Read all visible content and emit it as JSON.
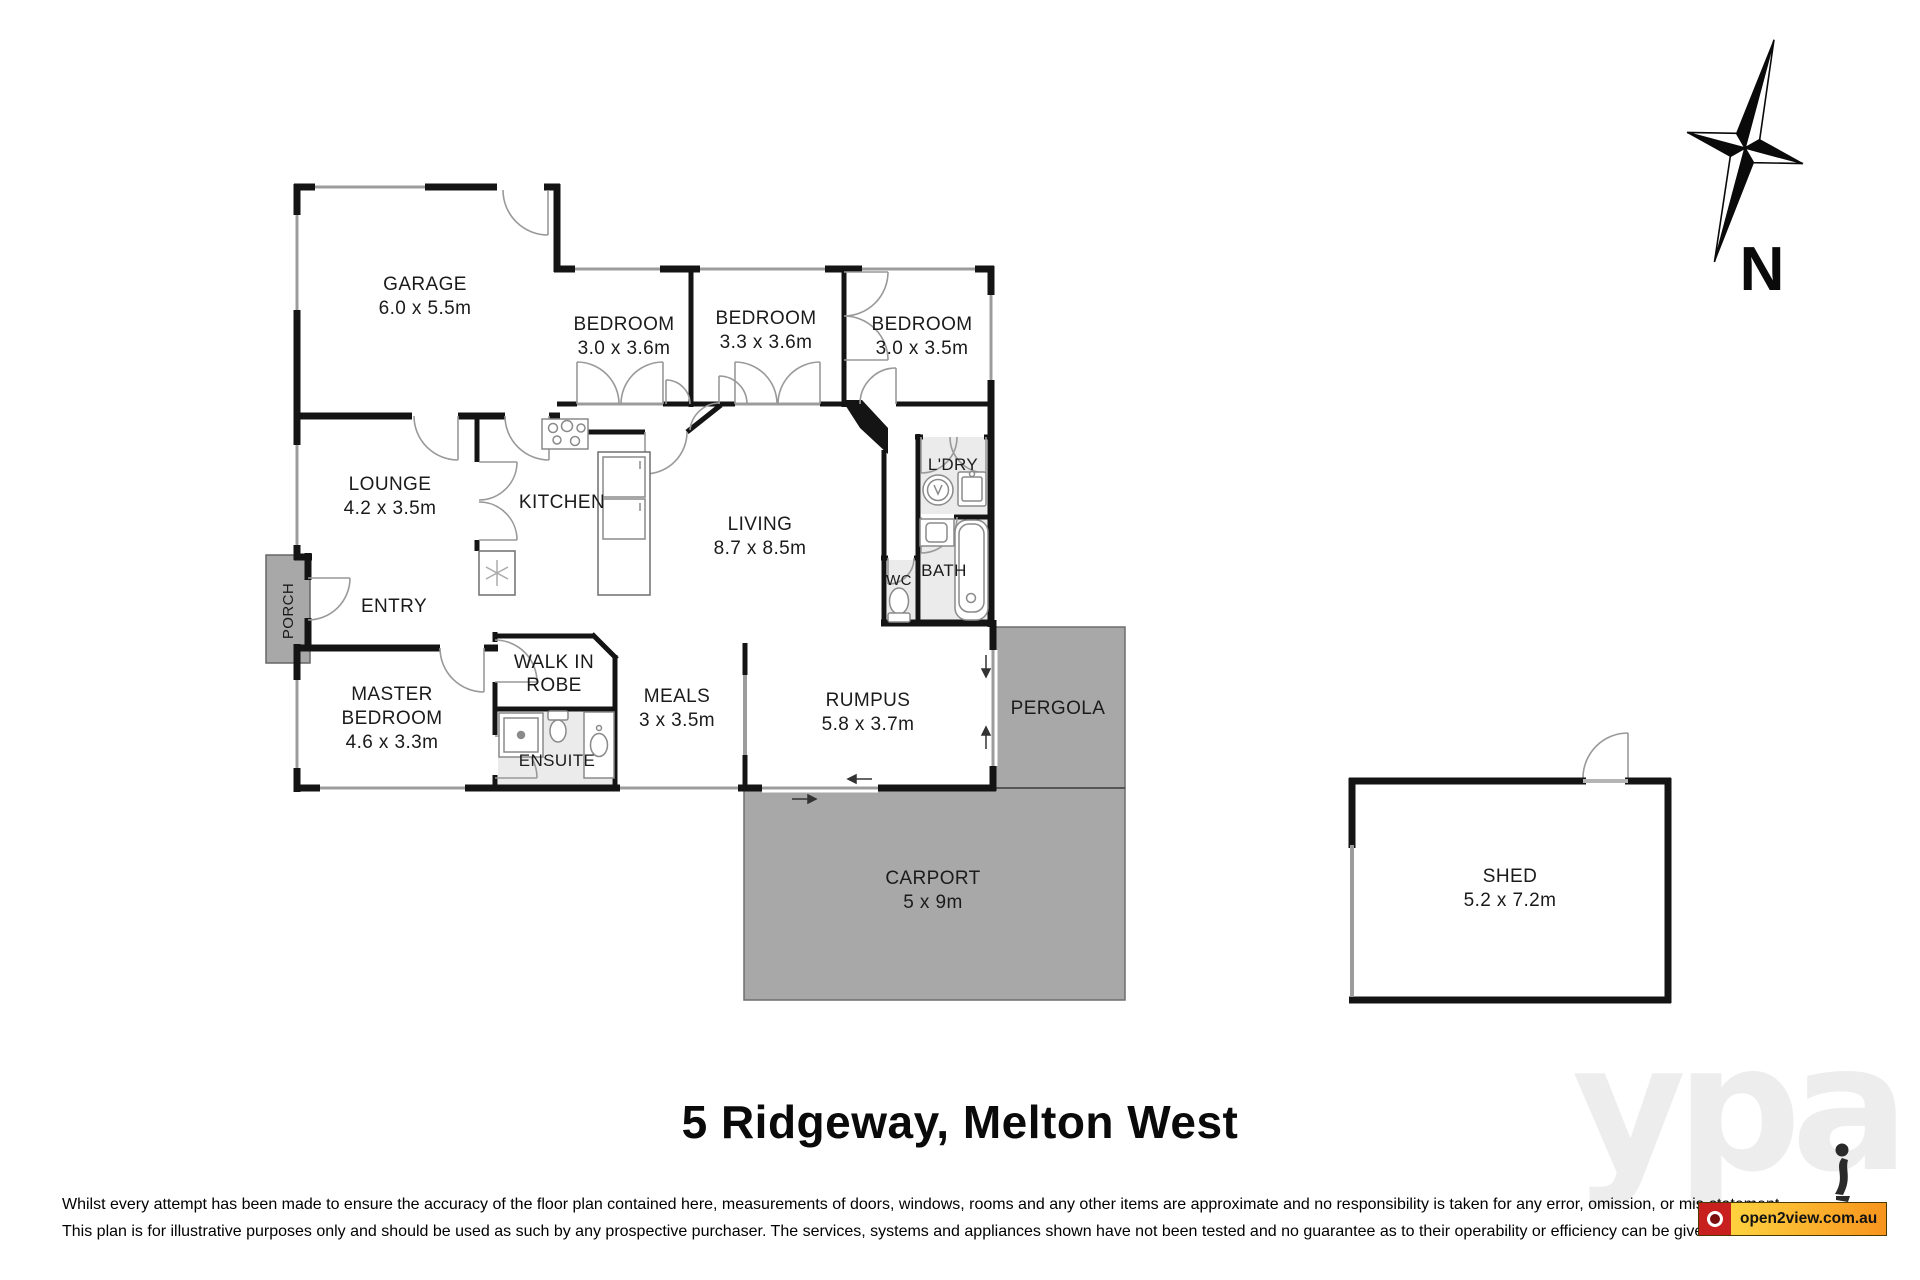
{
  "property": {
    "title": "5 Ridgeway, Melton West"
  },
  "compass": {
    "label": "N"
  },
  "rooms": {
    "garage": {
      "name": "GARAGE",
      "dims": "6.0 x 5.5m"
    },
    "bedroom1": {
      "name": "BEDROOM",
      "dims": "3.0 x 3.6m"
    },
    "bedroom2": {
      "name": "BEDROOM",
      "dims": "3.3 x 3.6m"
    },
    "bedroom3": {
      "name": "BEDROOM",
      "dims": "3.0 x 3.5m"
    },
    "lounge": {
      "name": "LOUNGE",
      "dims": "4.2 x 3.5m"
    },
    "kitchen": {
      "name": "KITCHEN"
    },
    "living": {
      "name": "LIVING",
      "dims": "8.7 x 8.5m"
    },
    "laundry": {
      "name": "L'DRY"
    },
    "bath": {
      "name": "BATH"
    },
    "wc": {
      "name": "WC"
    },
    "porch": {
      "name": "PORCH"
    },
    "entry": {
      "name": "ENTRY"
    },
    "master_bedroom": {
      "line1": "MASTER",
      "line2": "BEDROOM",
      "dims": "4.6 x 3.3m"
    },
    "walk_in_robe": {
      "line1": "WALK IN",
      "line2": "ROBE"
    },
    "ensuite": {
      "name": "ENSUITE"
    },
    "meals": {
      "name": "MEALS",
      "dims": "3 x 3.5m"
    },
    "rumpus": {
      "name": "RUMPUS",
      "dims": "5.8 x 3.7m"
    },
    "pergola": {
      "name": "PERGOLA"
    },
    "carport": {
      "name": "CARPORT",
      "dims": "5 x 9m"
    },
    "shed": {
      "name": "SHED",
      "dims": "5.2 x 7.2m"
    }
  },
  "footer": {
    "disclaimer_line1": "Whilst every attempt has been made to ensure the accuracy of the floor plan contained here, measurements of doors, windows, rooms and any other items are approximate and no responsibility is taken for any error, omission, or mis-statement.",
    "disclaimer_line2": "This plan is for illustrative purposes only and should be used as such by any prospective purchaser. The services, systems and appliances shown have not been tested and no guarantee as to their operability or efficiency can be given."
  },
  "branding": {
    "watermark": "ypa",
    "logo_text": "open2view.com.au"
  },
  "colors": {
    "wall": "#141414",
    "outdoor_fill": "#a8a8a8",
    "wet_area_fill": "#ebebeb",
    "logo_red": "#c8201e",
    "logo_gradient_start": "#fed23f",
    "logo_gradient_end": "#f7941d"
  }
}
